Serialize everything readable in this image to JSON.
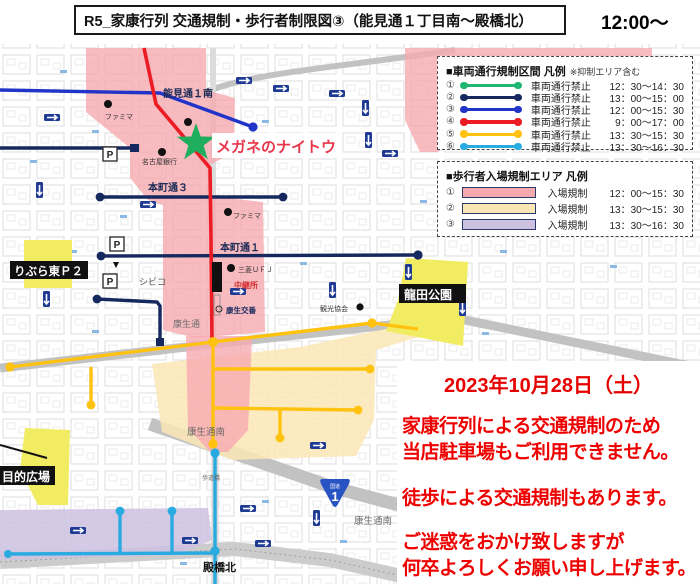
{
  "header": {
    "title": "R5_家康行列 交通規制・歩行者制限図③（能見通１丁目南～殿橋北）",
    "time": "12:00～"
  },
  "legend_vehicle": {
    "heading": "■車両通行規制区間 凡例",
    "note": "※抑制エリア含む",
    "rows": [
      {
        "num": "①",
        "label": "車両通行禁止",
        "time": "12：30～14：30",
        "color": "#1fb573"
      },
      {
        "num": "②",
        "label": "車両通行禁止",
        "time": "13：00～15：00",
        "color": "#16295f"
      },
      {
        "num": "③",
        "label": "車両通行禁止",
        "time": "12：00～15：30",
        "color": "#2134c8"
      },
      {
        "num": "④",
        "label": "車両通行禁止",
        "time": "9：00～17：00",
        "color": "#ec1c24"
      },
      {
        "num": "⑤",
        "label": "車両通行禁止",
        "time": "13：30～15：30",
        "color": "#ffc20e"
      },
      {
        "num": "⑥",
        "label": "車両通行禁止",
        "time": "13：30～16：30",
        "color": "#29abe2"
      }
    ]
  },
  "legend_pedestrian": {
    "heading": "■歩行者入場規制エリア 凡例",
    "rows": [
      {
        "num": "①",
        "label": "入場規制",
        "time": "12：00～15：30",
        "color": "#f6aab0"
      },
      {
        "num": "②",
        "label": "入場規制",
        "time": "13：30～15：30",
        "color": "#fbe6b5"
      },
      {
        "num": "③",
        "label": "入場規制",
        "time": "13：30～16：30",
        "color": "#cdc1e2"
      }
    ]
  },
  "notice": {
    "date": "2023年10月28日（土）",
    "lines": [
      "家康行列による交通規制のため",
      "当店駐車場もご利用できません。",
      "徒歩による交通規制もあります。",
      "ご迷惑をおかけ致しますが",
      "何卒よろしくお願い申し上げます。"
    ],
    "color": "#e60000"
  },
  "map": {
    "labels": {
      "nomimichi": "能見通１南",
      "megane": "メガネのナイトウ",
      "famima1": "ファミマ",
      "nagoyabank": "名古屋銀行",
      "honmachi3": "本町通３",
      "famima2": "ファミマ",
      "honmachi1": "本町通１",
      "mitsubishi": "三菱ＵＦＪ",
      "chukeisho": "中継所",
      "civico": "シビコ",
      "koseidori": "康生通",
      "koseikoban": "康生交番",
      "kanko": "観光協会",
      "koseiminami": "康生通南",
      "koseiminami2": "康生通南",
      "tonobashi": "殿橋北",
      "hodokyo": "歩道橋",
      "libra": "りぶら東Ｐ２",
      "tatsuta": "龍田公園",
      "hiroba": "目的広場",
      "parking": "P"
    },
    "route_shield": {
      "prefix": "国道",
      "number": "1"
    },
    "colors": {
      "megane_text": "#e8374a",
      "star_green": "#1fae5e",
      "park_yellow": "#f2ec63",
      "road_gray": "#c2c2c2",
      "badge_navy": "#1f3a93"
    }
  }
}
